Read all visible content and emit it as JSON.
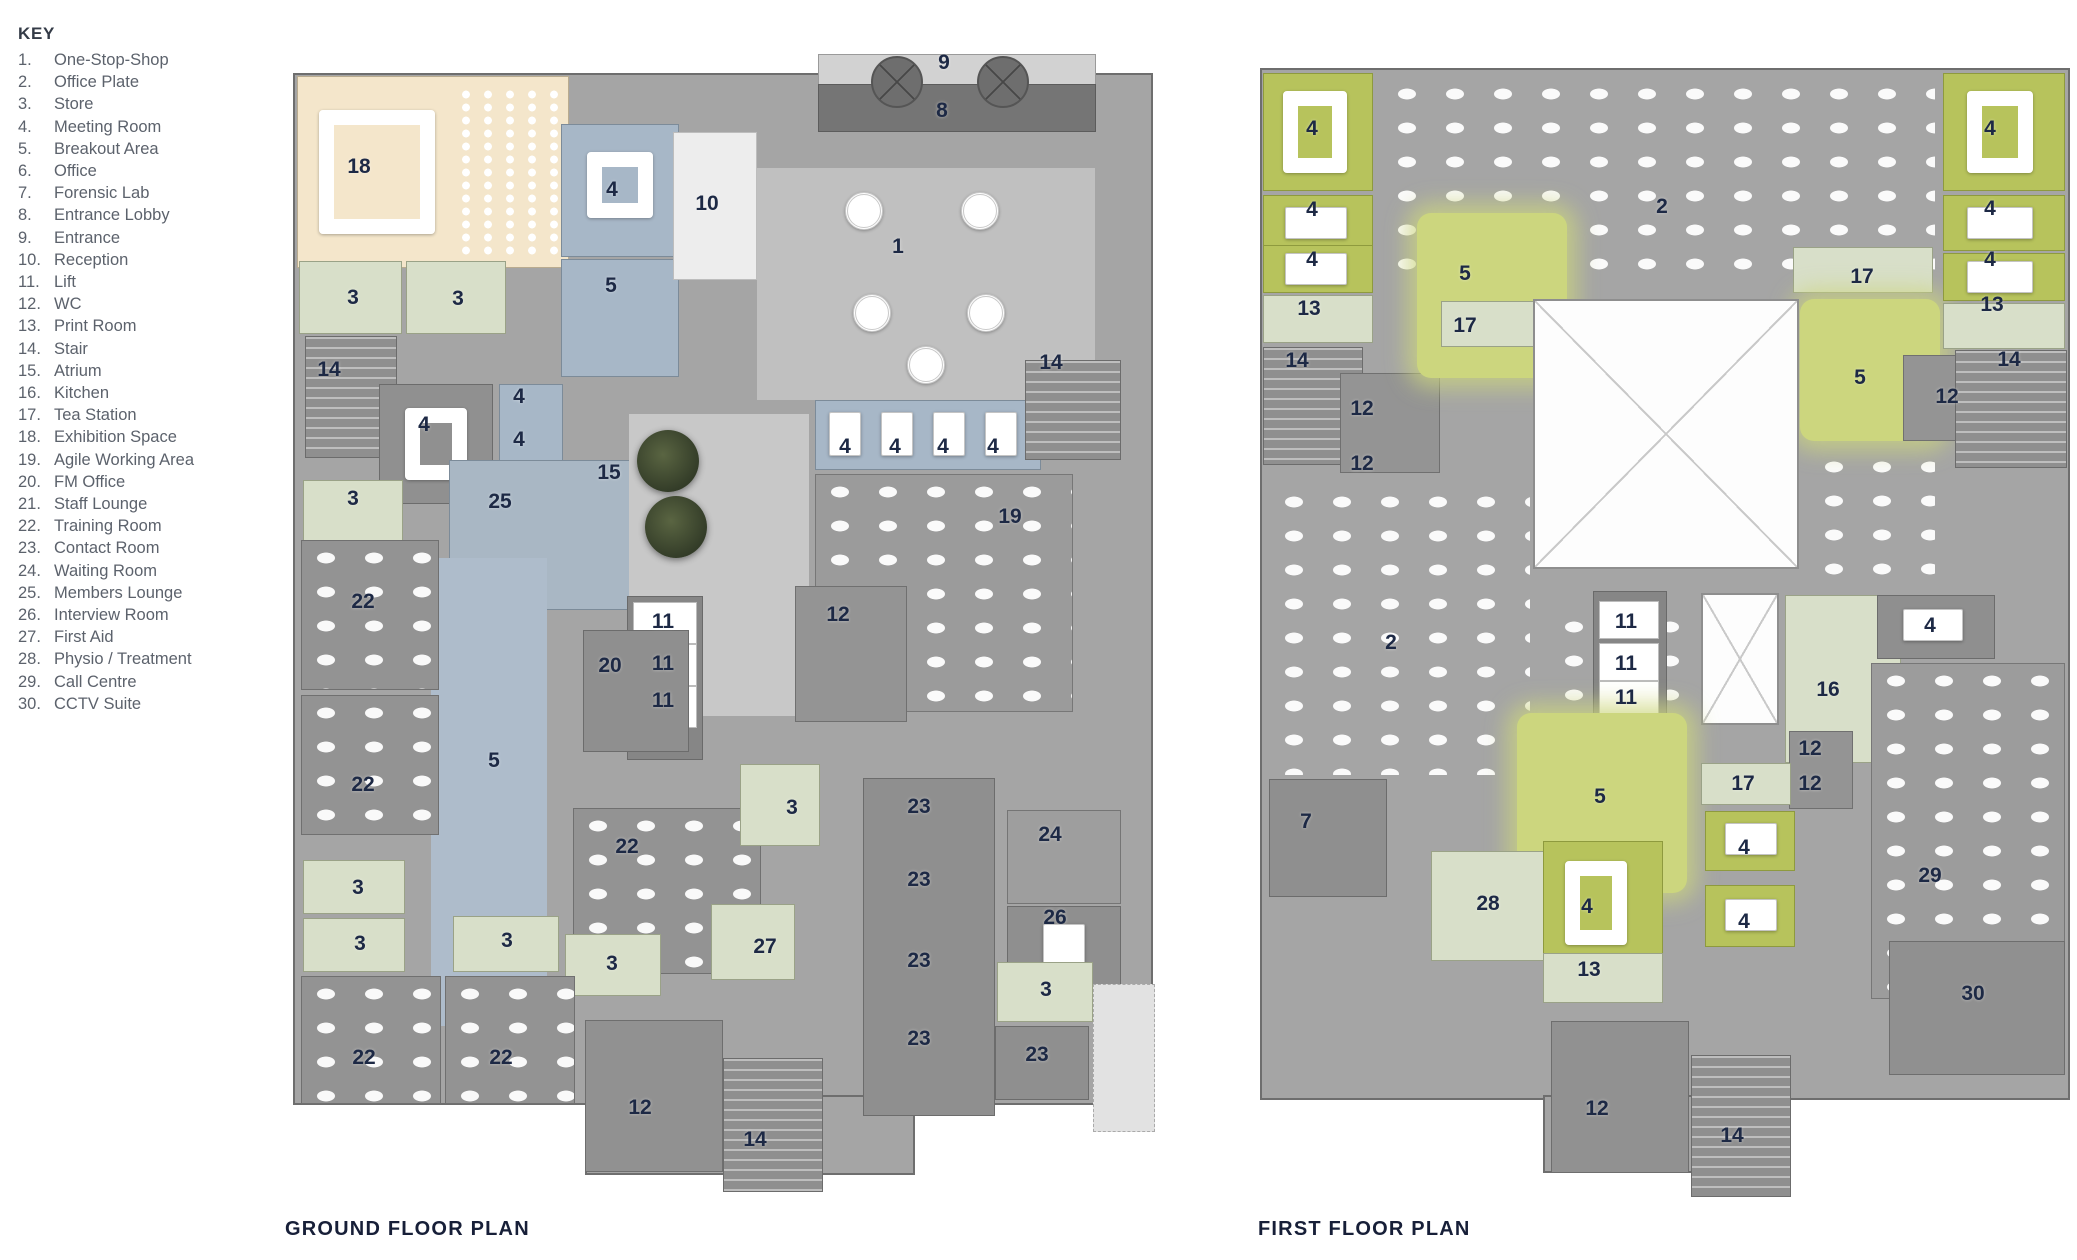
{
  "key": {
    "title": "KEY",
    "items": [
      {
        "num": "1.",
        "label": "One-Stop-Shop"
      },
      {
        "num": "2.",
        "label": "Office Plate"
      },
      {
        "num": "3.",
        "label": "Store"
      },
      {
        "num": "4.",
        "label": "Meeting Room"
      },
      {
        "num": "5.",
        "label": "Breakout Area"
      },
      {
        "num": "6.",
        "label": "Office"
      },
      {
        "num": "7.",
        "label": "Forensic Lab"
      },
      {
        "num": "8.",
        "label": "Entrance Lobby"
      },
      {
        "num": "9.",
        "label": "Entrance"
      },
      {
        "num": "10.",
        "label": "Reception"
      },
      {
        "num": "11.",
        "label": "Lift"
      },
      {
        "num": "12.",
        "label": "WC"
      },
      {
        "num": "13.",
        "label": "Print Room"
      },
      {
        "num": "14.",
        "label": "Stair"
      },
      {
        "num": "15.",
        "label": "Atrium"
      },
      {
        "num": "16.",
        "label": "Kitchen"
      },
      {
        "num": "17.",
        "label": "Tea Station"
      },
      {
        "num": "18.",
        "label": "Exhibition Space"
      },
      {
        "num": "19.",
        "label": "Agile Working Area"
      },
      {
        "num": "20.",
        "label": "FM Office"
      },
      {
        "num": "21.",
        "label": "Staff Lounge"
      },
      {
        "num": "22.",
        "label": "Training Room"
      },
      {
        "num": "23.",
        "label": "Contact Room"
      },
      {
        "num": "24.",
        "label": "Waiting Room"
      },
      {
        "num": "25.",
        "label": "Members Lounge"
      },
      {
        "num": "26.",
        "label": "Interview Room"
      },
      {
        "num": "27.",
        "label": "First Aid"
      },
      {
        "num": "28.",
        "label": "Physio / Treatment"
      },
      {
        "num": "29.",
        "label": "Call Centre"
      },
      {
        "num": "30.",
        "label": "CCTV Suite"
      }
    ]
  },
  "plans": [
    {
      "id": "ground",
      "title": "GROUND FLOOR PLAN",
      "labels": [
        {
          "t": "9",
          "x": 659,
          "y": 23
        },
        {
          "t": "8",
          "x": 657,
          "y": 71
        },
        {
          "t": "18",
          "x": 74,
          "y": 127
        },
        {
          "t": "4",
          "x": 327,
          "y": 150
        },
        {
          "t": "10",
          "x": 422,
          "y": 164
        },
        {
          "t": "1",
          "x": 613,
          "y": 207
        },
        {
          "t": "5",
          "x": 326,
          "y": 246
        },
        {
          "t": "3",
          "x": 68,
          "y": 258
        },
        {
          "t": "3",
          "x": 173,
          "y": 259
        },
        {
          "t": "14",
          "x": 44,
          "y": 330
        },
        {
          "t": "14",
          "x": 766,
          "y": 323
        },
        {
          "t": "4",
          "x": 234,
          "y": 357
        },
        {
          "t": "4",
          "x": 139,
          "y": 385
        },
        {
          "t": "4",
          "x": 234,
          "y": 400
        },
        {
          "t": "4",
          "x": 560,
          "y": 407
        },
        {
          "t": "4",
          "x": 610,
          "y": 407
        },
        {
          "t": "4",
          "x": 658,
          "y": 407
        },
        {
          "t": "4",
          "x": 708,
          "y": 407
        },
        {
          "t": "15",
          "x": 324,
          "y": 433
        },
        {
          "t": "3",
          "x": 68,
          "y": 459
        },
        {
          "t": "25",
          "x": 215,
          "y": 462
        },
        {
          "t": "19",
          "x": 725,
          "y": 477
        },
        {
          "t": "22",
          "x": 78,
          "y": 562
        },
        {
          "t": "12",
          "x": 553,
          "y": 575
        },
        {
          "t": "11",
          "x": 378,
          "y": 582
        },
        {
          "t": "11",
          "x": 378,
          "y": 624
        },
        {
          "t": "20",
          "x": 325,
          "y": 626
        },
        {
          "t": "11",
          "x": 378,
          "y": 661
        },
        {
          "t": "5",
          "x": 209,
          "y": 721
        },
        {
          "t": "22",
          "x": 78,
          "y": 745
        },
        {
          "t": "3",
          "x": 507,
          "y": 768
        },
        {
          "t": "23",
          "x": 634,
          "y": 767
        },
        {
          "t": "24",
          "x": 765,
          "y": 795
        },
        {
          "t": "22",
          "x": 342,
          "y": 807
        },
        {
          "t": "23",
          "x": 634,
          "y": 840
        },
        {
          "t": "3",
          "x": 73,
          "y": 848
        },
        {
          "t": "26",
          "x": 770,
          "y": 878
        },
        {
          "t": "3",
          "x": 75,
          "y": 904
        },
        {
          "t": "3",
          "x": 222,
          "y": 901
        },
        {
          "t": "27",
          "x": 480,
          "y": 907
        },
        {
          "t": "23",
          "x": 634,
          "y": 921
        },
        {
          "t": "3",
          "x": 327,
          "y": 924
        },
        {
          "t": "3",
          "x": 761,
          "y": 950
        },
        {
          "t": "23",
          "x": 634,
          "y": 999
        },
        {
          "t": "23",
          "x": 752,
          "y": 1015
        },
        {
          "t": "22",
          "x": 79,
          "y": 1018
        },
        {
          "t": "22",
          "x": 216,
          "y": 1018
        },
        {
          "t": "12",
          "x": 355,
          "y": 1068
        },
        {
          "t": "14",
          "x": 470,
          "y": 1100
        }
      ]
    },
    {
      "id": "first",
      "title": "FIRST FLOOR PLAN",
      "labels": [
        {
          "t": "4",
          "x": 57,
          "y": 74
        },
        {
          "t": "4",
          "x": 735,
          "y": 74
        },
        {
          "t": "2",
          "x": 407,
          "y": 152
        },
        {
          "t": "4",
          "x": 57,
          "y": 155
        },
        {
          "t": "4",
          "x": 735,
          "y": 154
        },
        {
          "t": "4",
          "x": 57,
          "y": 205
        },
        {
          "t": "4",
          "x": 735,
          "y": 205
        },
        {
          "t": "5",
          "x": 210,
          "y": 219
        },
        {
          "t": "17",
          "x": 607,
          "y": 222
        },
        {
          "t": "13",
          "x": 54,
          "y": 254
        },
        {
          "t": "13",
          "x": 737,
          "y": 250
        },
        {
          "t": "17",
          "x": 210,
          "y": 271
        },
        {
          "t": "14",
          "x": 42,
          "y": 306
        },
        {
          "t": "14",
          "x": 754,
          "y": 305
        },
        {
          "t": "5",
          "x": 605,
          "y": 323
        },
        {
          "t": "12",
          "x": 107,
          "y": 354
        },
        {
          "t": "12",
          "x": 692,
          "y": 342
        },
        {
          "t": "12",
          "x": 107,
          "y": 409
        },
        {
          "t": "2",
          "x": 136,
          "y": 588
        },
        {
          "t": "11",
          "x": 371,
          "y": 567
        },
        {
          "t": "11",
          "x": 371,
          "y": 609
        },
        {
          "t": "11",
          "x": 371,
          "y": 643
        },
        {
          "t": "16",
          "x": 573,
          "y": 635
        },
        {
          "t": "4",
          "x": 675,
          "y": 571
        },
        {
          "t": "12",
          "x": 555,
          "y": 694
        },
        {
          "t": "12",
          "x": 555,
          "y": 729
        },
        {
          "t": "17",
          "x": 488,
          "y": 729
        },
        {
          "t": "5",
          "x": 345,
          "y": 742
        },
        {
          "t": "7",
          "x": 51,
          "y": 767
        },
        {
          "t": "4",
          "x": 489,
          "y": 793
        },
        {
          "t": "29",
          "x": 675,
          "y": 821
        },
        {
          "t": "28",
          "x": 233,
          "y": 849
        },
        {
          "t": "4",
          "x": 332,
          "y": 852
        },
        {
          "t": "4",
          "x": 489,
          "y": 867
        },
        {
          "t": "13",
          "x": 334,
          "y": 915
        },
        {
          "t": "30",
          "x": 718,
          "y": 939
        },
        {
          "t": "12",
          "x": 342,
          "y": 1054
        },
        {
          "t": "14",
          "x": 477,
          "y": 1081
        }
      ]
    }
  ],
  "colors": {
    "room_label": "#1d2945",
    "key_text": "#5c626c",
    "title_text": "#171f38",
    "plan_gray": "#a5a5a5",
    "exhibition_beige": "#f4e6cb",
    "store_sage": "#d8dfc9",
    "meeting_blue": "#a7b7c7",
    "meeting_olive": "#b7c35c",
    "breakout_olive": "#ccd67e",
    "entrance_dark": "#757575"
  }
}
